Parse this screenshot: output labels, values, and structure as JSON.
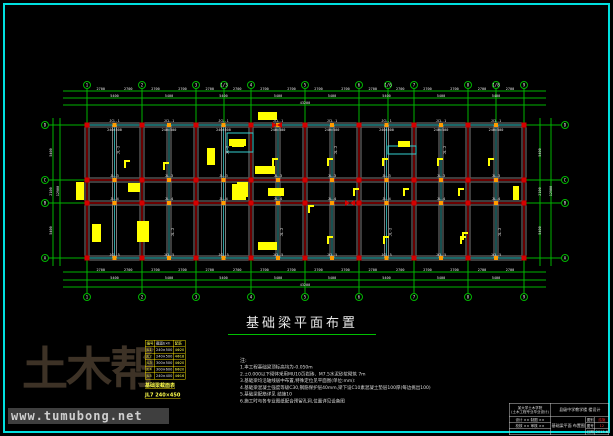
{
  "colors": {
    "bg": "#000000",
    "frame": "#00e0e0",
    "green": "#00b400",
    "red": "#d40000",
    "teal": "#30a0a0",
    "gray": "#7a7a7a",
    "yellow": "#ffff00",
    "orange": "#ff9c00",
    "white": "#e8e8e8",
    "cyan": "#35d0d0",
    "brown": "#3d3226",
    "strip_bg": "#3f3f3f",
    "strip_text": "#cfcfcf",
    "value_red": "#ff2a2a"
  },
  "watermark": {
    "logo": "土木帮",
    "url": "www.tumubong.net"
  },
  "title": {
    "text": "基础梁平面布置"
  },
  "notes": {
    "heading": "注:",
    "lines": [
      "1.本工程基础梁顶标高均为-0.050m",
      "2.±0.000以下砌体采用MU10页岩砖、M7.5水泥砂浆砌筑 7m",
      "3.基础梁均沿轴线居中布置,特殊定位见平面图(单位:mm):",
      "4.基础梁混凝土强度等级C30,钢筋保护层40mm,梁下设C10素混凝土垫层100厚(每边挑出100)",
      "5.基础梁配筋详见 结施10",
      "6.施工时与各专业图纸配合预留孔洞,位置详见设备图"
    ]
  },
  "schedule": {
    "rows": [
      [
        "编号",
        "截面b×h",
        "配筋"
      ],
      [
        "JL1",
        "240×500",
        "4Φ20"
      ],
      [
        "JL2",
        "240×500",
        "4Φ18"
      ],
      [
        "JL3",
        "300×500",
        "4Φ20"
      ],
      [
        "JL4",
        "300×600",
        "6Φ20"
      ],
      [
        "JL5",
        "240×400",
        "4Φ16"
      ]
    ],
    "footer1": "基础梁截面表",
    "footer2": "JL7 240×450"
  },
  "title_block": {
    "org": "某大学土木学院",
    "org2": "(土木工程专业毕业设计)",
    "project": "县级中学教学楼 楼设计",
    "drawing": "基础梁平面 布置图",
    "left_fields": [
      [
        "设计",
        "××",
        "制图",
        "××"
      ],
      [
        "校核",
        "××",
        "审核",
        "××"
      ]
    ],
    "fields": [
      {
        "label": "图别",
        "value": "结施",
        "red": true
      },
      {
        "label": "图号",
        "value": "12",
        "red": true
      },
      {
        "label": "日期",
        "value": "2013.6",
        "red": false
      }
    ]
  },
  "plan": {
    "x_main": [
      87,
      142,
      196,
      251,
      305,
      359,
      414,
      468,
      524
    ],
    "x_sub": [
      114.5,
      169,
      223.5,
      278,
      332,
      386.5,
      441,
      496
    ],
    "y_axes": [
      125,
      180,
      203,
      258
    ],
    "top_bubbles": [
      {
        "x": 87,
        "l": "1"
      },
      {
        "x": 142,
        "l": "2"
      },
      {
        "x": 196,
        "l": "3"
      },
      {
        "x": 224,
        "l": "1/3"
      },
      {
        "x": 251,
        "l": "4"
      },
      {
        "x": 305,
        "l": "5"
      },
      {
        "x": 359,
        "l": "6"
      },
      {
        "x": 388,
        "l": "1/6"
      },
      {
        "x": 414,
        "l": "7"
      },
      {
        "x": 468,
        "l": "8"
      },
      {
        "x": 496,
        "l": "1/8"
      },
      {
        "x": 524,
        "l": "9"
      }
    ],
    "bottom_bubble_labels": [
      "1",
      "2",
      "3",
      "4",
      "5",
      "6",
      "7",
      "8",
      "9"
    ],
    "side_bubble_labels_bottom_up": [
      "A",
      "B",
      "C",
      "D"
    ],
    "dims": {
      "half_bay": "2700",
      "bay": "5400",
      "total_x": "43200",
      "side": [
        "5400",
        "2100",
        "5400"
      ],
      "total_y": "12900"
    },
    "beam_labels": {
      "top_outer": "JCL-1",
      "top_inner": "240×500",
      "mid_upper": "JL-3",
      "mid_lower": "JL-4",
      "bottom": "JCL-5",
      "vertical": "JL-2"
    },
    "stair_boxes": [
      [
        227,
        133,
        26,
        19
      ],
      [
        388,
        146,
        28,
        8
      ]
    ],
    "yellow_tags": [
      [
        232,
        141,
        12,
        6,
        "b"
      ],
      [
        255,
        166,
        20,
        8,
        "b"
      ],
      [
        232,
        184,
        14,
        16,
        "b"
      ],
      [
        268,
        188,
        16,
        8,
        "b"
      ],
      [
        207,
        148,
        8,
        17,
        "b"
      ],
      [
        229,
        139,
        17,
        7,
        "b"
      ],
      [
        258,
        112,
        19,
        8,
        "b"
      ],
      [
        76,
        182,
        8,
        18,
        "b"
      ],
      [
        128,
        183,
        12,
        9,
        "b"
      ],
      [
        237,
        182,
        11,
        15,
        "b"
      ],
      [
        92,
        224,
        9,
        18,
        "b"
      ],
      [
        137,
        221,
        12,
        21,
        "b"
      ],
      [
        258,
        242,
        19,
        8,
        "b"
      ],
      [
        513,
        186,
        6,
        14,
        "b"
      ],
      [
        398,
        141,
        12,
        6,
        "b"
      ],
      [
        124,
        160,
        0,
        0,
        "l"
      ],
      [
        163,
        162,
        0,
        0,
        "l"
      ],
      [
        272,
        158,
        0,
        0,
        "l"
      ],
      [
        327,
        158,
        0,
        0,
        "l"
      ],
      [
        382,
        158,
        0,
        0,
        "l"
      ],
      [
        437,
        158,
        0,
        0,
        "l"
      ],
      [
        488,
        158,
        0,
        0,
        "l"
      ],
      [
        353,
        188,
        0,
        0,
        "l"
      ],
      [
        403,
        188,
        0,
        0,
        "l"
      ],
      [
        458,
        188,
        0,
        0,
        "l"
      ],
      [
        327,
        236,
        0,
        0,
        "l"
      ],
      [
        383,
        236,
        0,
        0,
        "l"
      ],
      [
        460,
        236,
        0,
        0,
        "l"
      ],
      [
        462,
        232,
        0,
        0,
        "l"
      ],
      [
        308,
        205,
        0,
        0,
        "l"
      ]
    ],
    "section_marks": [
      [
        277,
        125
      ],
      [
        350,
        203
      ]
    ]
  }
}
